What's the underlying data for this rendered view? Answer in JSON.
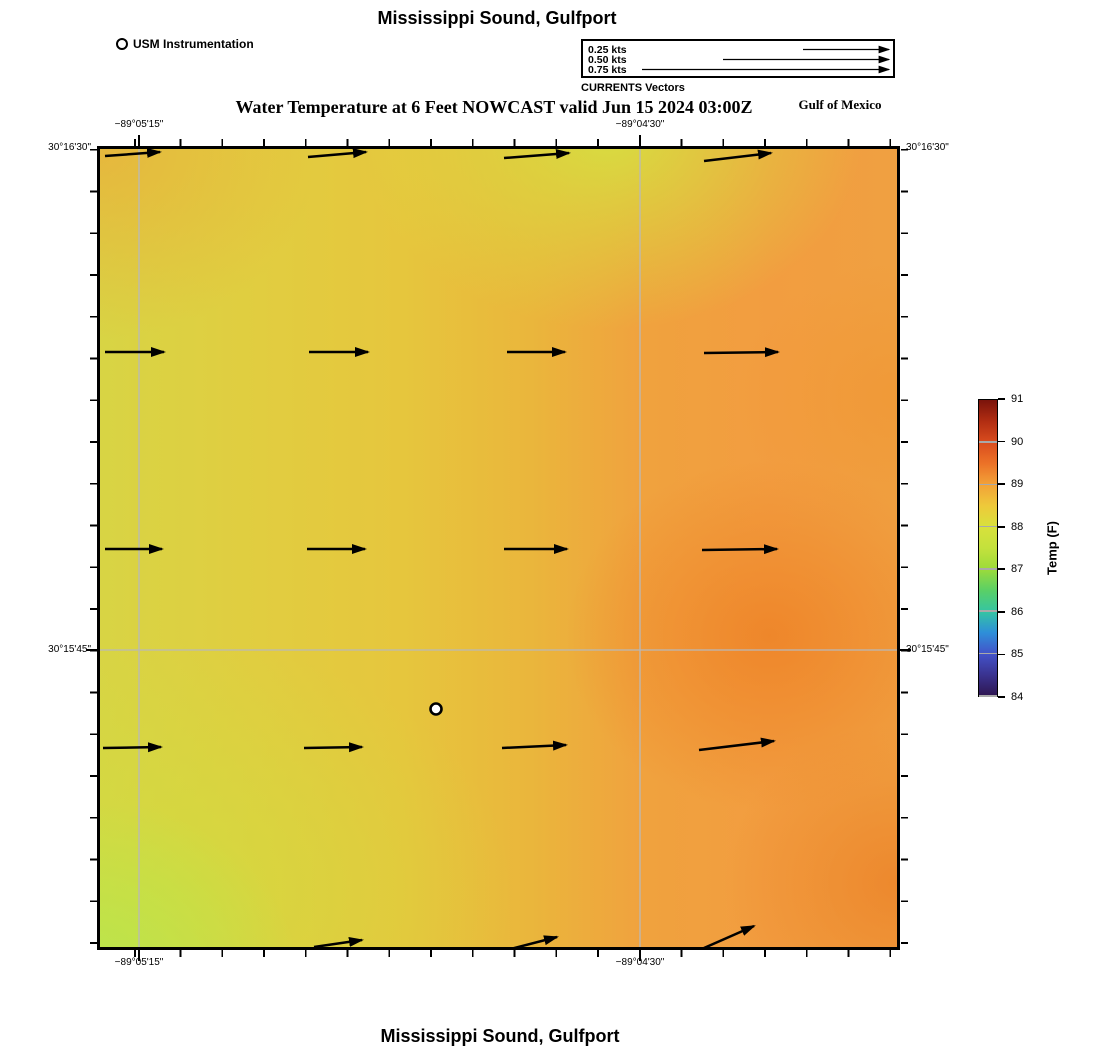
{
  "header": {
    "title_top": "Mississippi Sound, Gulfport",
    "usm_legend_label": "USM Instrumentation",
    "vector_legend": {
      "caption": "CURRENTS Vectors",
      "tip_x": 306,
      "rows": [
        {
          "label": "0.25 kts",
          "tail_x": 220
        },
        {
          "label": "0.50 kts",
          "tail_x": 140
        },
        {
          "label": "0.75 kts",
          "tail_x": 59
        }
      ]
    },
    "subtitle": "Water Temperature at 6 Feet NOWCAST valid Jun 15 2024 03:00Z",
    "region_label": "Gulf of Mexico"
  },
  "footer": {
    "title_bottom": "Mississippi Sound, Gulfport"
  },
  "axes": {
    "top": [
      {
        "text": "−89°05'15\"",
        "x": 139
      },
      {
        "text": "−89°04'30\"",
        "x": 640
      }
    ],
    "bottom": [
      {
        "text": "−89°05'15\"",
        "x": 139
      },
      {
        "text": "−89°04'30\"",
        "x": 640
      }
    ],
    "left": [
      {
        "text": "30°16'30\"",
        "y": 148
      },
      {
        "text": "30°15'45\"",
        "y": 650
      }
    ],
    "right": [
      {
        "text": "30°16'30\"",
        "y": 148
      },
      {
        "text": "30°15'45\"",
        "y": 650
      }
    ]
  },
  "colorbar": {
    "label": "Temp (F)",
    "min": 84,
    "max": 91,
    "ticks": [
      91,
      90,
      89,
      88,
      87,
      86,
      85,
      84
    ],
    "bar_gridlines": [
      90,
      89,
      88,
      87,
      86,
      85,
      84
    ],
    "stops": [
      {
        "v": 84.0,
        "c": "#2e1650"
      },
      {
        "v": 84.5,
        "c": "#3a3390"
      },
      {
        "v": 85.0,
        "c": "#4353c9"
      },
      {
        "v": 85.5,
        "c": "#2e8fd9"
      },
      {
        "v": 86.0,
        "c": "#35c5a2"
      },
      {
        "v": 86.5,
        "c": "#5ad066"
      },
      {
        "v": 87.0,
        "c": "#9cdb3a"
      },
      {
        "v": 87.5,
        "c": "#c4e13c"
      },
      {
        "v": 88.0,
        "c": "#d8e13c"
      },
      {
        "v": 88.5,
        "c": "#eec93a"
      },
      {
        "v": 89.0,
        "c": "#f2a238"
      },
      {
        "v": 89.5,
        "c": "#ec7227"
      },
      {
        "v": 90.0,
        "c": "#d94c1e"
      },
      {
        "v": 90.5,
        "c": "#b12d12"
      },
      {
        "v": 91.0,
        "c": "#7a130b"
      }
    ]
  },
  "map": {
    "gridline_color": "#b9b9b9",
    "gridlines": {
      "vertical": [
        39,
        540
      ],
      "horizontal": [
        501
      ]
    },
    "station": {
      "x": 336,
      "y": 560,
      "r": 5.5
    },
    "arrows": [
      {
        "x1": 5,
        "y1": 7,
        "x2": 60,
        "y2": 3
      },
      {
        "x1": 208,
        "y1": 8,
        "x2": 266,
        "y2": 3
      },
      {
        "x1": 404,
        "y1": 9,
        "x2": 469,
        "y2": 4
      },
      {
        "x1": 604,
        "y1": 12,
        "x2": 671,
        "y2": 4
      },
      {
        "x1": 5,
        "y1": 203,
        "x2": 64,
        "y2": 203
      },
      {
        "x1": 209,
        "y1": 203,
        "x2": 268,
        "y2": 203
      },
      {
        "x1": 407,
        "y1": 203,
        "x2": 465,
        "y2": 203
      },
      {
        "x1": 604,
        "y1": 204,
        "x2": 678,
        "y2": 203
      },
      {
        "x1": 5,
        "y1": 400,
        "x2": 62,
        "y2": 400
      },
      {
        "x1": 207,
        "y1": 400,
        "x2": 265,
        "y2": 400
      },
      {
        "x1": 404,
        "y1": 400,
        "x2": 467,
        "y2": 400
      },
      {
        "x1": 602,
        "y1": 401,
        "x2": 677,
        "y2": 400
      },
      {
        "x1": 3,
        "y1": 599,
        "x2": 61,
        "y2": 598
      },
      {
        "x1": 204,
        "y1": 599,
        "x2": 262,
        "y2": 598
      },
      {
        "x1": 402,
        "y1": 599,
        "x2": 466,
        "y2": 596
      },
      {
        "x1": 599,
        "y1": 601,
        "x2": 674,
        "y2": 592
      },
      {
        "x1": 214,
        "y1": 798,
        "x2": 262,
        "y2": 791
      },
      {
        "x1": 399,
        "y1": 803,
        "x2": 457,
        "y2": 788
      },
      {
        "x1": 604,
        "y1": 799,
        "x2": 654,
        "y2": 777
      }
    ]
  },
  "palette": {
    "field_left_yellow": "#d8d444",
    "field_center_gold": "#e6c63d",
    "field_right_orange": "#f29d40",
    "field_warm_blob": "#ee8428",
    "field_bottom_left_green": "#b7e74d",
    "gridline": "#b9b9b9",
    "ink": "#000000"
  },
  "chart_data": {
    "type": "heatmap",
    "title": "Mississippi Sound, Gulfport",
    "subtitle": "Water Temperature at 6 Feet NOWCAST valid Jun 15 2024 03:00Z",
    "region": "Gulf of Mexico",
    "x_ticks": [
      "−89°05'15\"",
      "−89°04'30\""
    ],
    "y_ticks": [
      "30°16'30\"",
      "30°15'45\""
    ],
    "colorbar_label": "Temp (F)",
    "colorbar_range": [
      84,
      91
    ],
    "colorbar_tick_values": [
      84,
      85,
      86,
      87,
      88,
      89,
      90,
      91
    ],
    "grid_note": "approx water temperature (F) sampled on 5x5 grid, west-to-east columns, north-to-south rows",
    "values": [
      [
        88.4,
        88.2,
        88.0,
        88.6,
        89.0
      ],
      [
        88.3,
        88.3,
        88.3,
        88.9,
        89.1
      ],
      [
        88.2,
        88.4,
        88.5,
        89.3,
        89.1
      ],
      [
        88.1,
        88.3,
        88.5,
        89.2,
        89.2
      ],
      [
        87.8,
        88.0,
        88.4,
        88.8,
        89.2
      ]
    ],
    "vectors": {
      "legend_speeds_kts": [
        0.25,
        0.5,
        0.75
      ],
      "field_direction": "eastward",
      "field_speed_kts_approx": "0.15–0.25",
      "station_marker": "USM Instrumentation at approx −89°04'52\", 30°15'39\""
    }
  }
}
